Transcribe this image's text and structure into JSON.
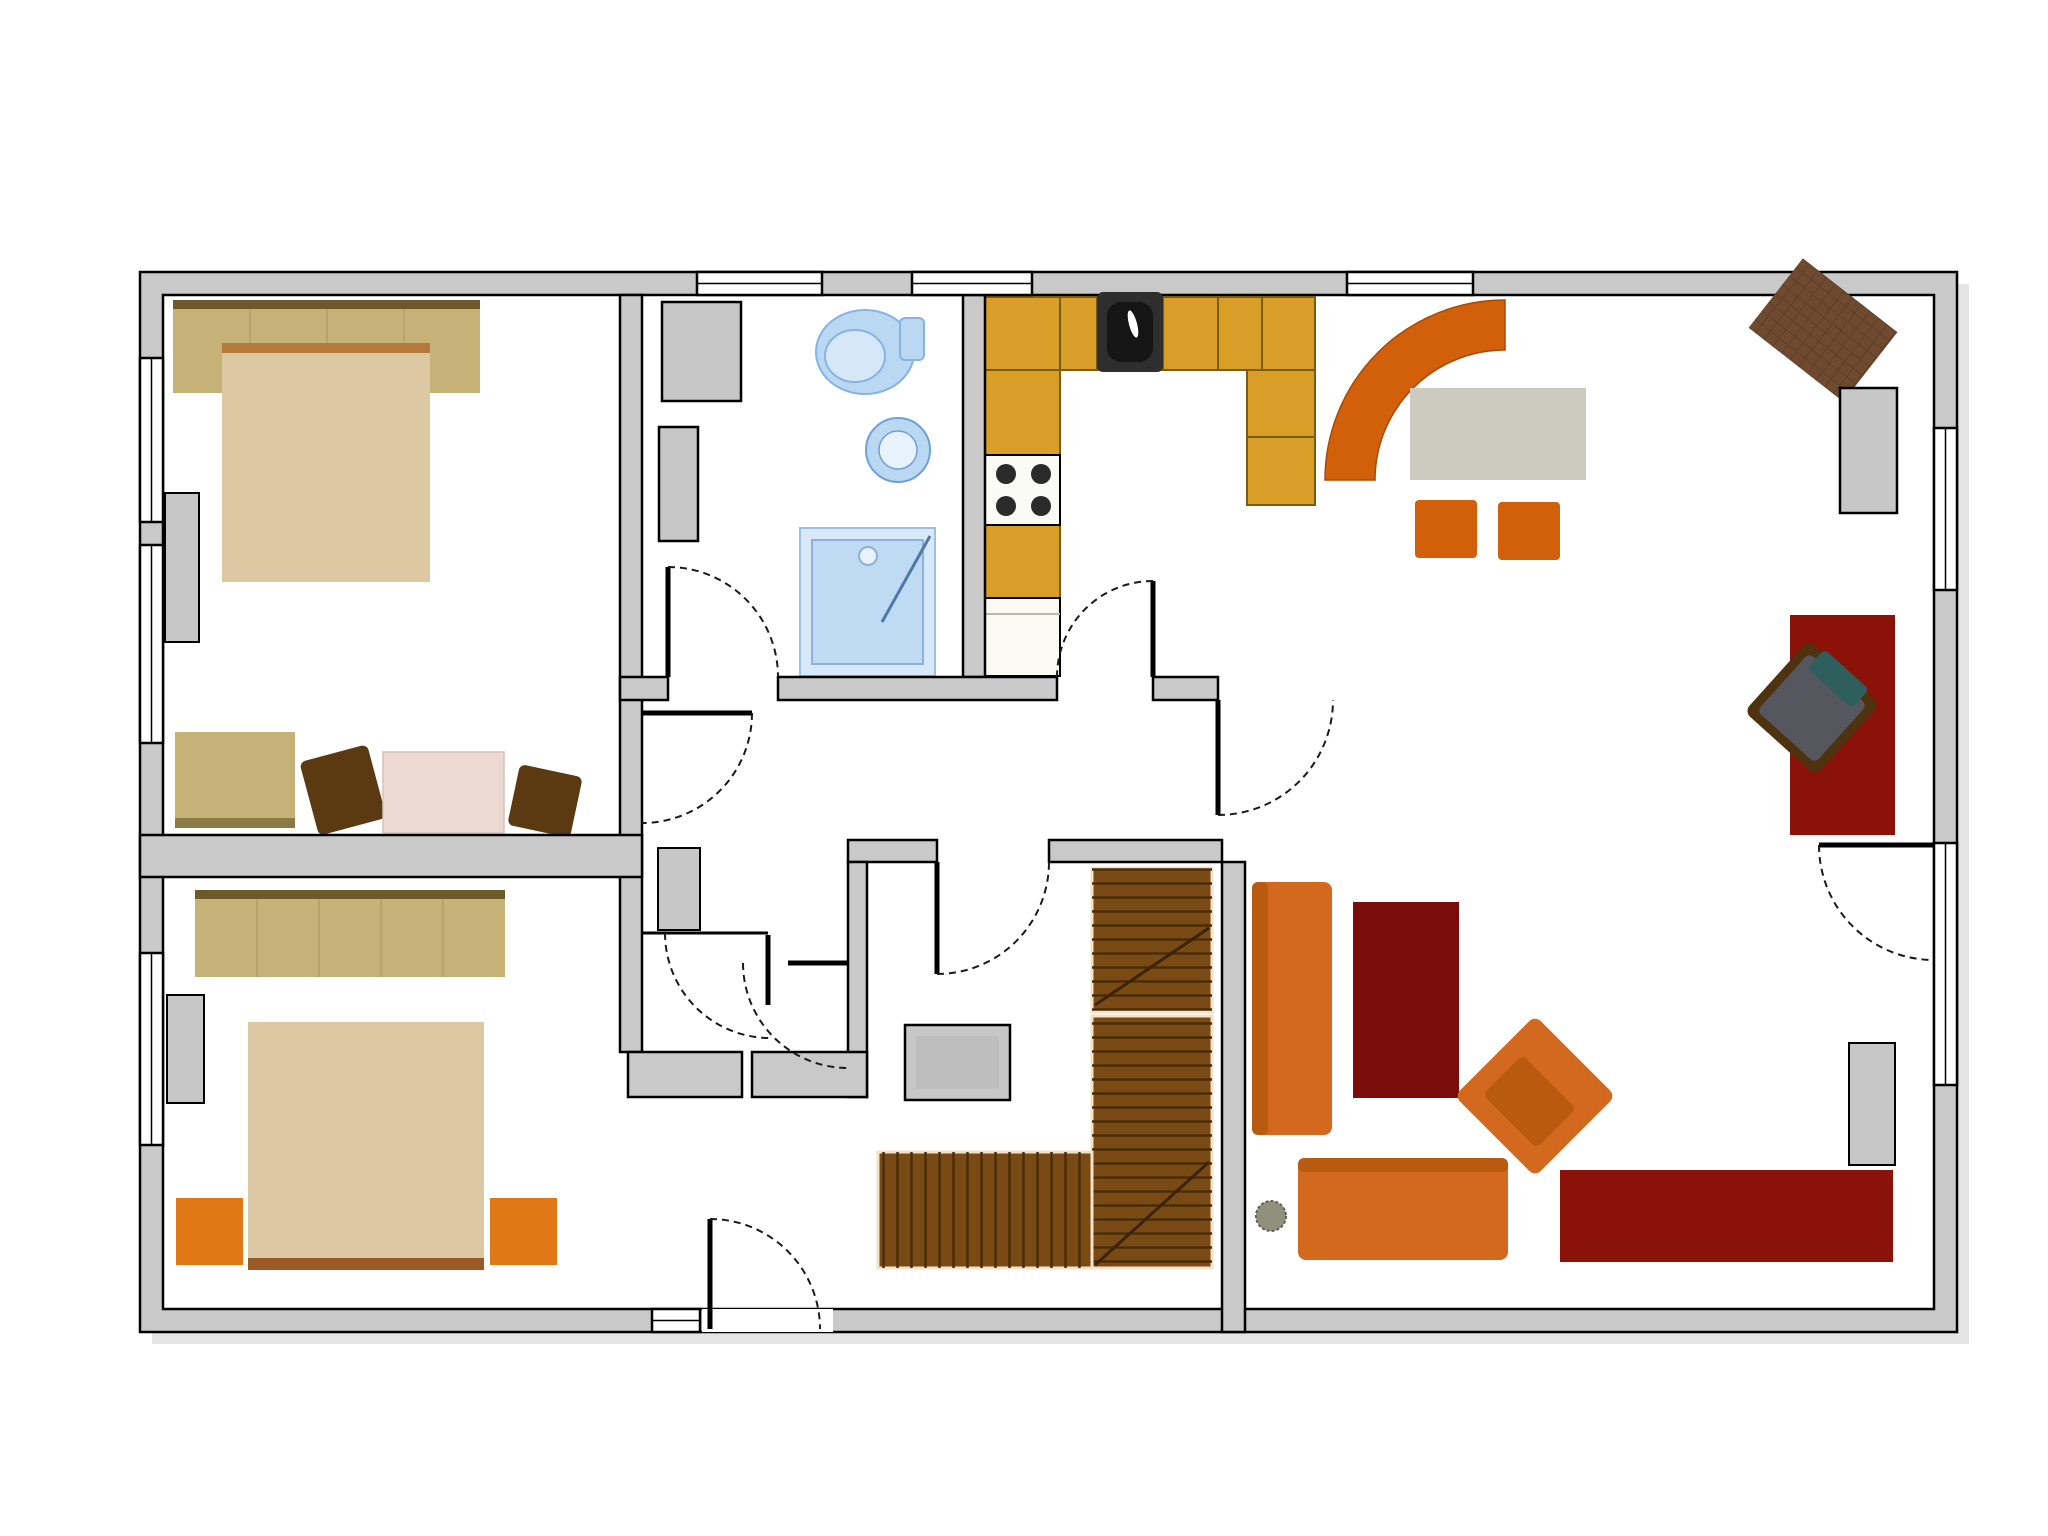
{
  "page": {
    "background": "#FFFFFF",
    "description": "2D architectural floor plan, ground floor, no text labels"
  },
  "colors": {
    "wall": "#C9C9C9",
    "floor": "#FFFFFF",
    "shadow": "#E4E4E4",
    "line": "#000000",
    "tan_furniture": "#C6B277",
    "tan_dark": "#6E5A28",
    "tan_strip": "#8A7A45",
    "bed": "#DCC9A4",
    "headboard": "#B5793B",
    "footboard": "#9A5A28",
    "gray_item": "#C7C7C7",
    "gray_inner": "#BEBEBE",
    "table_gray": "#CBCBC0",
    "pink": "#EBD9D2",
    "chair_brown": "#5C3A11",
    "orange": "#E07818",
    "sofa_orange": "#D2691E",
    "sofa_shade": "#B85A10",
    "bench_orange": "#D2600A",
    "amber": "#D89E28",
    "sink_dark": "#2E2E2E",
    "sink_bowl": "#151515",
    "stove_white": "#FBFBF5",
    "burner": "#2A2A2A",
    "cab_white": "#FAFAF2",
    "wood": "#7A4A15",
    "dark_red": "#8B1209",
    "rug_red": "#7B0C0C",
    "blue_fill": "#BBD8F2",
    "blue_deep": "#D6E8F8",
    "shower_fill": "#D7E8F8",
    "shower_inner": "#BFDBF4",
    "shower_glass": "#E8F2FC",
    "rug_brown": "#6F4A30",
    "chair_gray": "#56565E",
    "chair_base": "#4F3210",
    "teal": "#2E5F5C",
    "plant": "#90907C",
    "white_glass": "#FFFFFF"
  },
  "rooms": [
    {
      "name": "bedroom-1",
      "position": "top-left"
    },
    {
      "name": "bedroom-2",
      "position": "bottom-left"
    },
    {
      "name": "bathroom",
      "position": "top-center"
    },
    {
      "name": "kitchen",
      "position": "top-center-right"
    },
    {
      "name": "dining-area",
      "position": "top-right"
    },
    {
      "name": "office-nook",
      "position": "right"
    },
    {
      "name": "living-room",
      "position": "bottom-right"
    },
    {
      "name": "hallway-vestibule",
      "position": "center"
    },
    {
      "name": "stair-room",
      "position": "center-bottom"
    },
    {
      "name": "entry",
      "position": "bottom-center"
    }
  ],
  "elements": [
    "double-bed x2",
    "wardrobe x2",
    "nightstand x2",
    "dresser",
    "side-chairs",
    "pink-side-table",
    "toilet",
    "wash-basin",
    "shower",
    "bathroom-cabinet",
    "radiators",
    "kitchen-L-counter",
    "kitchen-sink",
    "stove-4-burners",
    "under-counter-cabinet",
    "curved-corner-bench",
    "dining-table",
    "dining-chairs x2",
    "desk",
    "office-chair",
    "diagonal-rug",
    "shelf-cabinets",
    "sofa x2",
    "armchair-rotated",
    "red-rug",
    "tv-board",
    "plant",
    "u-shaped-wooden-staircase",
    "washing-machine",
    "door-swings x9",
    "windows x9"
  ]
}
